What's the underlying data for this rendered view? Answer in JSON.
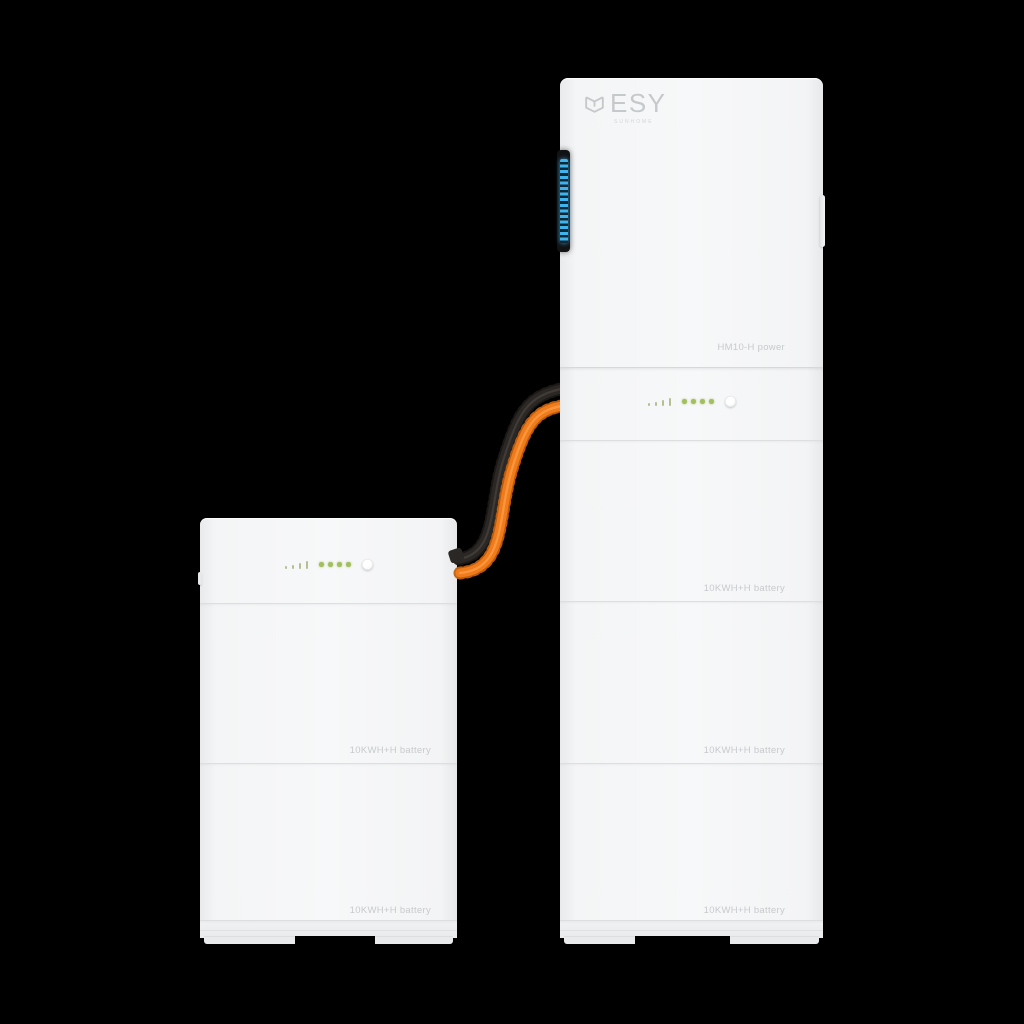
{
  "scene": {
    "background_color": "#000000"
  },
  "tower": {
    "brand_logo": "ESY",
    "brand_logo_subtext": "SUNHOME",
    "model_label": "HM10-H power",
    "battery_labels": [
      "10KWH+H battery",
      "10KWH+H battery",
      "10KWH+H battery"
    ],
    "indicator": {
      "signal_bar_count": 4,
      "status_dot_count": 4
    },
    "led_strip_color": "#3fb3ee"
  },
  "side_unit": {
    "battery_labels": [
      "10KWH+H battery",
      "10KWH+H battery"
    ],
    "indicator": {
      "signal_bar_count": 4,
      "status_dot_count": 4
    }
  },
  "cables": {
    "orange_color": "#ee7b1c",
    "dark_color": "#2b2724"
  },
  "colors": {
    "body_white": "#f4f5f6",
    "seam": "#dddfe1",
    "label_text": "#c7cacd",
    "indicator_green": "#a2bf60",
    "led_blue": "#3fb3ee",
    "button_white": "#ffffff"
  }
}
